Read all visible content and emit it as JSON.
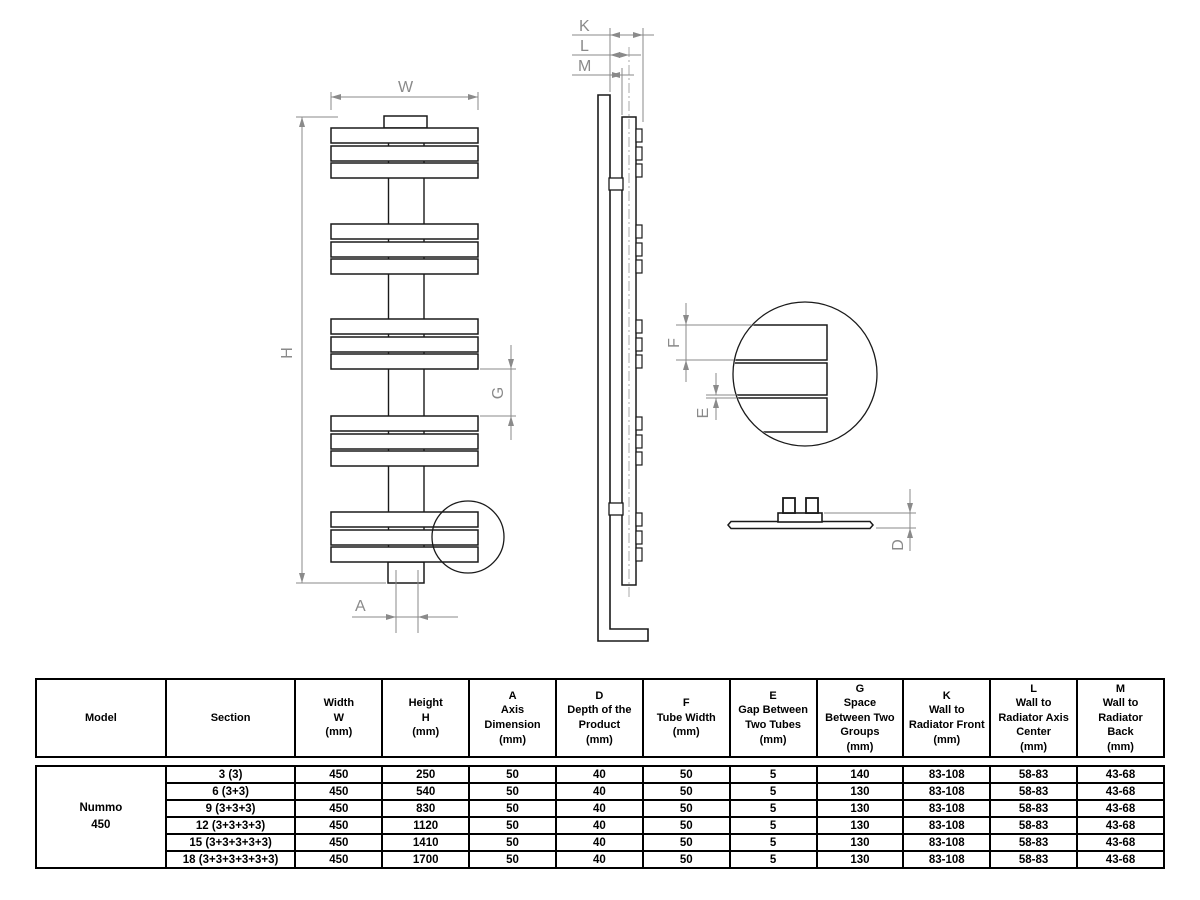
{
  "drawing": {
    "labels": {
      "W": "W",
      "H": "H",
      "G": "G",
      "A": "A",
      "K": "K",
      "L": "L",
      "M": "M",
      "F": "F",
      "E": "E",
      "D": "D"
    }
  },
  "table": {
    "headers": [
      "Model",
      "Section",
      "Width\nW\n(mm)",
      "Height\nH\n(mm)",
      "A\nAxis\nDimension\n(mm)",
      "D\nDepth of the\nProduct\n(mm)",
      "F\nTube Width\n(mm)",
      "E\nGap Between\nTwo Tubes\n(mm)",
      "G\nSpace\nBetween Two\nGroups\n(mm)",
      "K\nWall to\nRadiator Front\n(mm)",
      "L\nWall to\nRadiator Axis\nCenter\n(mm)",
      "M\nWall to\nRadiator\nBack\n(mm)"
    ],
    "model": "Nummo\n450",
    "rows": [
      [
        "3 (3)",
        "450",
        "250",
        "50",
        "40",
        "50",
        "5",
        "140",
        "83-108",
        "58-83",
        "43-68"
      ],
      [
        "6 (3+3)",
        "450",
        "540",
        "50",
        "40",
        "50",
        "5",
        "130",
        "83-108",
        "58-83",
        "43-68"
      ],
      [
        "9 (3+3+3)",
        "450",
        "830",
        "50",
        "40",
        "50",
        "5",
        "130",
        "83-108",
        "58-83",
        "43-68"
      ],
      [
        "12 (3+3+3+3)",
        "450",
        "1120",
        "50",
        "40",
        "50",
        "5",
        "130",
        "83-108",
        "58-83",
        "43-68"
      ],
      [
        "15 (3+3+3+3+3)",
        "450",
        "1410",
        "50",
        "40",
        "50",
        "5",
        "130",
        "83-108",
        "58-83",
        "43-68"
      ],
      [
        "18 (3+3+3+3+3+3)",
        "450",
        "1700",
        "50",
        "40",
        "50",
        "5",
        "130",
        "83-108",
        "58-83",
        "43-68"
      ]
    ]
  }
}
